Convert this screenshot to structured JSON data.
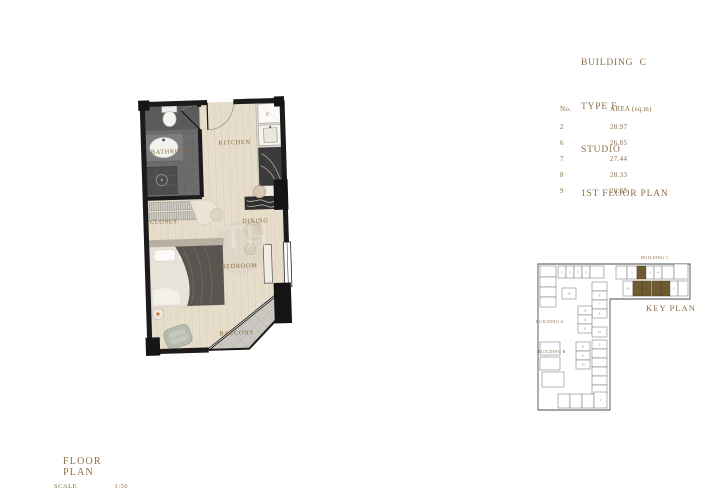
{
  "title_block": {
    "line1": "BUILDING  C",
    "line2": "TYPE F",
    "line3": "STUDIO",
    "line4": "1ST FLOOR PLAN"
  },
  "area_table": {
    "col_no": "No.",
    "col_area": "AREA (sq.m)",
    "rows": [
      {
        "no": "2",
        "area": "28.97"
      },
      {
        "no": "6",
        "area": "26.85"
      },
      {
        "no": "7",
        "area": "27.44"
      },
      {
        "no": "8",
        "area": "28.33"
      },
      {
        "no": "9",
        "area": "26.85"
      }
    ]
  },
  "floor_plan": {
    "rooms": {
      "bathroom": "BATHROOM",
      "kitchen": "KITCHEN",
      "closet": "CLOSET",
      "dining": "DINING",
      "bedroom": "BEDROOM",
      "balcony": "BALCONY"
    },
    "fridge_label": "F",
    "watermark": "TH"
  },
  "key_plan": {
    "title": "KEY PLAN",
    "building_c_label": "BUILDING C",
    "building_a_label": "BUILDING A",
    "building_b_label": "BUILDING B",
    "highlighted_units": [
      "2",
      "6",
      "7",
      "8",
      "9"
    ],
    "cells": [
      {
        "x": 88,
        "y": 24,
        "w": 11,
        "h": 13,
        "no": ""
      },
      {
        "x": 99,
        "y": 24,
        "w": 10,
        "h": 13,
        "no": "1"
      },
      {
        "x": 109,
        "y": 24,
        "w": 9,
        "h": 13,
        "no": "2",
        "filled": true
      },
      {
        "x": 118,
        "y": 24,
        "w": 8,
        "h": 13,
        "no": "3"
      },
      {
        "x": 126,
        "y": 24,
        "w": 8,
        "h": 13,
        "no": "4"
      },
      {
        "x": 134,
        "y": 24,
        "w": 12,
        "h": 13,
        "no": ""
      },
      {
        "x": 146,
        "y": 22,
        "w": 14,
        "h": 15,
        "no": ""
      },
      {
        "x": 95,
        "y": 39,
        "w": 10,
        "h": 15,
        "no": "10"
      },
      {
        "x": 105,
        "y": 39,
        "w": 9,
        "h": 15,
        "no": "9",
        "filled": true
      },
      {
        "x": 114,
        "y": 39,
        "w": 9,
        "h": 15,
        "no": "8",
        "filled": true
      },
      {
        "x": 124,
        "y": 39,
        "w": 9,
        "h": 15,
        "no": "7",
        "filled": true
      },
      {
        "x": 133,
        "y": 39,
        "w": 9,
        "h": 15,
        "no": "6",
        "filled": true
      },
      {
        "x": 142,
        "y": 39,
        "w": 8,
        "h": 15,
        "no": "5"
      },
      {
        "x": 150,
        "y": 39,
        "w": 10,
        "h": 15,
        "no": ""
      },
      {
        "x": 12,
        "y": 24,
        "w": 16,
        "h": 11,
        "no": ""
      },
      {
        "x": 12,
        "y": 35,
        "w": 16,
        "h": 10,
        "no": ""
      },
      {
        "x": 12,
        "y": 45,
        "w": 16,
        "h": 10,
        "no": ""
      },
      {
        "x": 12,
        "y": 55,
        "w": 16,
        "h": 10,
        "no": ""
      },
      {
        "x": 30,
        "y": 24,
        "w": 8,
        "h": 12,
        "no": "1"
      },
      {
        "x": 38,
        "y": 24,
        "w": 8,
        "h": 12,
        "no": "2"
      },
      {
        "x": 46,
        "y": 24,
        "w": 8,
        "h": 12,
        "no": "3"
      },
      {
        "x": 54,
        "y": 24,
        "w": 8,
        "h": 12,
        "no": "4"
      },
      {
        "x": 62,
        "y": 24,
        "w": 14,
        "h": 12,
        "no": ""
      },
      {
        "x": 34,
        "y": 46,
        "w": 14,
        "h": 11,
        "no": "14"
      },
      {
        "x": 64,
        "y": 40,
        "w": 15,
        "h": 9,
        "no": ""
      },
      {
        "x": 64,
        "y": 49,
        "w": 15,
        "h": 9,
        "no": "6"
      },
      {
        "x": 64,
        "y": 58,
        "w": 15,
        "h": 9,
        "no": "7"
      },
      {
        "x": 64,
        "y": 67,
        "w": 15,
        "h": 9,
        "no": "8"
      },
      {
        "x": 50,
        "y": 64,
        "w": 14,
        "h": 9,
        "no": "13"
      },
      {
        "x": 50,
        "y": 73,
        "w": 14,
        "h": 9,
        "no": "12"
      },
      {
        "x": 50,
        "y": 82,
        "w": 14,
        "h": 9,
        "no": "11"
      },
      {
        "x": 64,
        "y": 85,
        "w": 15,
        "h": 10,
        "no": "10"
      },
      {
        "x": 48,
        "y": 100,
        "w": 14,
        "h": 9,
        "no": "8"
      },
      {
        "x": 48,
        "y": 109,
        "w": 14,
        "h": 9,
        "no": "9"
      },
      {
        "x": 48,
        "y": 118,
        "w": 14,
        "h": 9,
        "no": "10"
      },
      {
        "x": 64,
        "y": 98,
        "w": 15,
        "h": 9,
        "no": "2"
      },
      {
        "x": 64,
        "y": 107,
        "w": 15,
        "h": 9,
        "no": ""
      },
      {
        "x": 64,
        "y": 116,
        "w": 15,
        "h": 9,
        "no": ""
      },
      {
        "x": 64,
        "y": 125,
        "w": 15,
        "h": 9,
        "no": ""
      },
      {
        "x": 64,
        "y": 134,
        "w": 15,
        "h": 9,
        "no": ""
      },
      {
        "x": 64,
        "y": 143,
        "w": 15,
        "h": 9,
        "no": ""
      },
      {
        "x": 12,
        "y": 100,
        "w": 20,
        "h": 13,
        "no": ""
      },
      {
        "x": 12,
        "y": 115,
        "w": 20,
        "h": 13,
        "no": ""
      },
      {
        "x": 14,
        "y": 130,
        "w": 22,
        "h": 15,
        "no": ""
      },
      {
        "x": 30,
        "y": 152,
        "w": 12,
        "h": 14,
        "no": ""
      },
      {
        "x": 42,
        "y": 152,
        "w": 12,
        "h": 14,
        "no": ""
      },
      {
        "x": 54,
        "y": 152,
        "w": 12,
        "h": 14,
        "no": ""
      },
      {
        "x": 66,
        "y": 150,
        "w": 13,
        "h": 16,
        "no": "1"
      }
    ]
  },
  "footer": {
    "title": "FLOOR PLAN",
    "scale_label": "SCALE",
    "scale_value": "1:50"
  },
  "colors": {
    "gold": "#8a6f47",
    "highlight_unit": "#6f5b30",
    "wall": "#1b1b1b",
    "floor": "#e7ddcb",
    "bathroom_floor": "#6c6c6c",
    "balcony_floor": "#cbc8c1"
  }
}
